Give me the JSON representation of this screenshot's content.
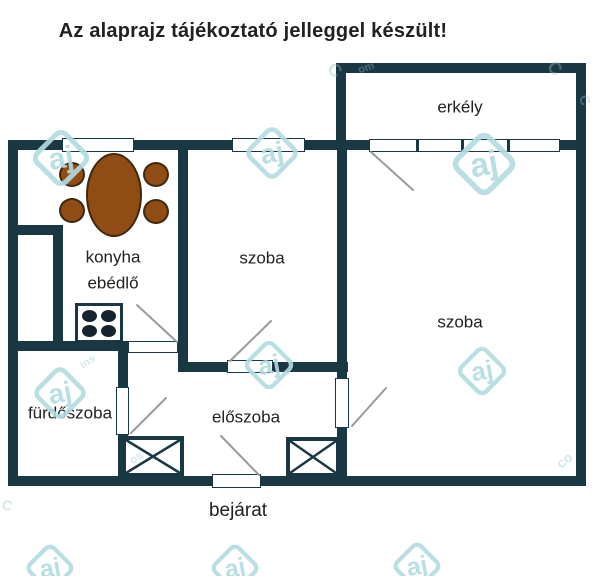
{
  "title": "Az alaprajz tájékoztató jelleggel készült!",
  "plan": {
    "labels": {
      "balcony": "erkély",
      "room1": "szoba",
      "room2": "szoba",
      "kitchen_line1": "konyha",
      "kitchen_line2": "ebédlő",
      "bathroom": "fürdőszoba",
      "hallway": "előszoba",
      "entrance": "bejárat"
    }
  },
  "watermark": {
    "logo_text": "aj",
    "fragments": [
      "C",
      "om",
      "C",
      "C",
      "co",
      "C",
      "os",
      "ins"
    ]
  },
  "colors": {
    "wall": "#1a3843",
    "table": "#8f4d15",
    "watermark": "#b3dce1",
    "text": "#212121",
    "swing": "#9a9a9a",
    "burner": "#15242e"
  }
}
